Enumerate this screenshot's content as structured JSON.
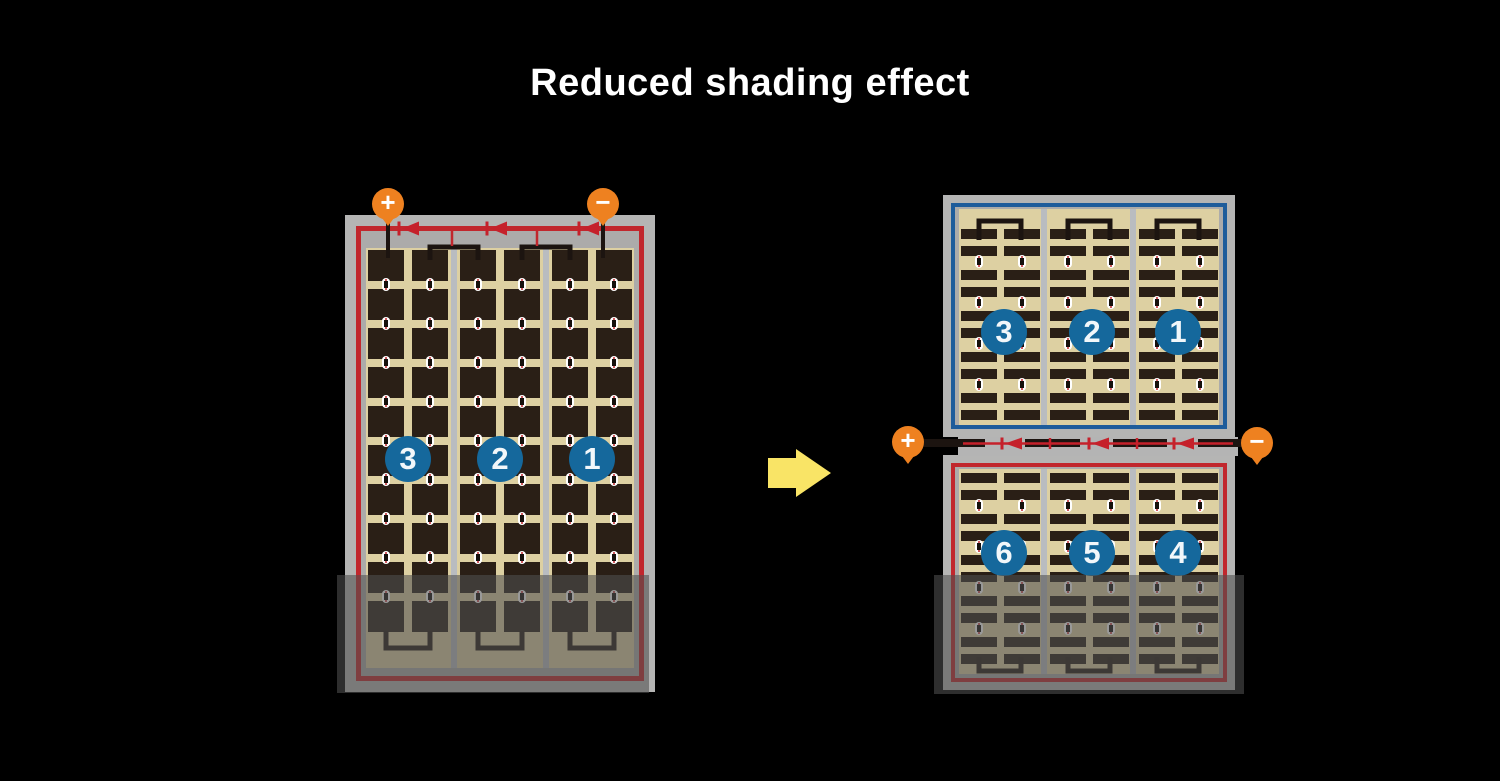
{
  "title": "Reduced shading effect",
  "colors": {
    "background": "#000000",
    "title_text": "#ffffff",
    "module_frame_gray": "#b5b5b4",
    "cell_area_tan": "#ddd0a2",
    "cell_dark_brown": "#2a1f16",
    "wire_red": "#c1272d",
    "wire_blue": "#1e5c9b",
    "wire_black": "#1c1410",
    "terminal_orange": "#ee8120",
    "string_badge_blue": "#15689c",
    "string_divider_gray": "#b9bcc0",
    "arrow_yellow": "#f9e466",
    "shade_overlay": "rgba(79,79,79,0.58)"
  },
  "left_module": {
    "terminals": {
      "positive": "+",
      "negative": "−"
    },
    "bypass_diodes": 3,
    "cell_rows": 10,
    "cell_columns_per_string": 2,
    "strings": [
      {
        "number": "3"
      },
      {
        "number": "2"
      },
      {
        "number": "1"
      }
    ],
    "shading": "bottom rows shaded"
  },
  "right_module": {
    "terminals": {
      "positive": "+",
      "negative": "−"
    },
    "bypass_diodes": 3,
    "top_half": {
      "border_color": "#1e5c9b",
      "strip_rows": 10,
      "strings": [
        {
          "number": "3"
        },
        {
          "number": "2"
        },
        {
          "number": "1"
        }
      ]
    },
    "bottom_half": {
      "border_color": "#c1272d",
      "strip_rows": 10,
      "strings": [
        {
          "number": "6"
        },
        {
          "number": "5"
        },
        {
          "number": "4"
        }
      ],
      "shading": "bottom rows shaded"
    }
  },
  "arrow": {
    "direction": "right"
  }
}
